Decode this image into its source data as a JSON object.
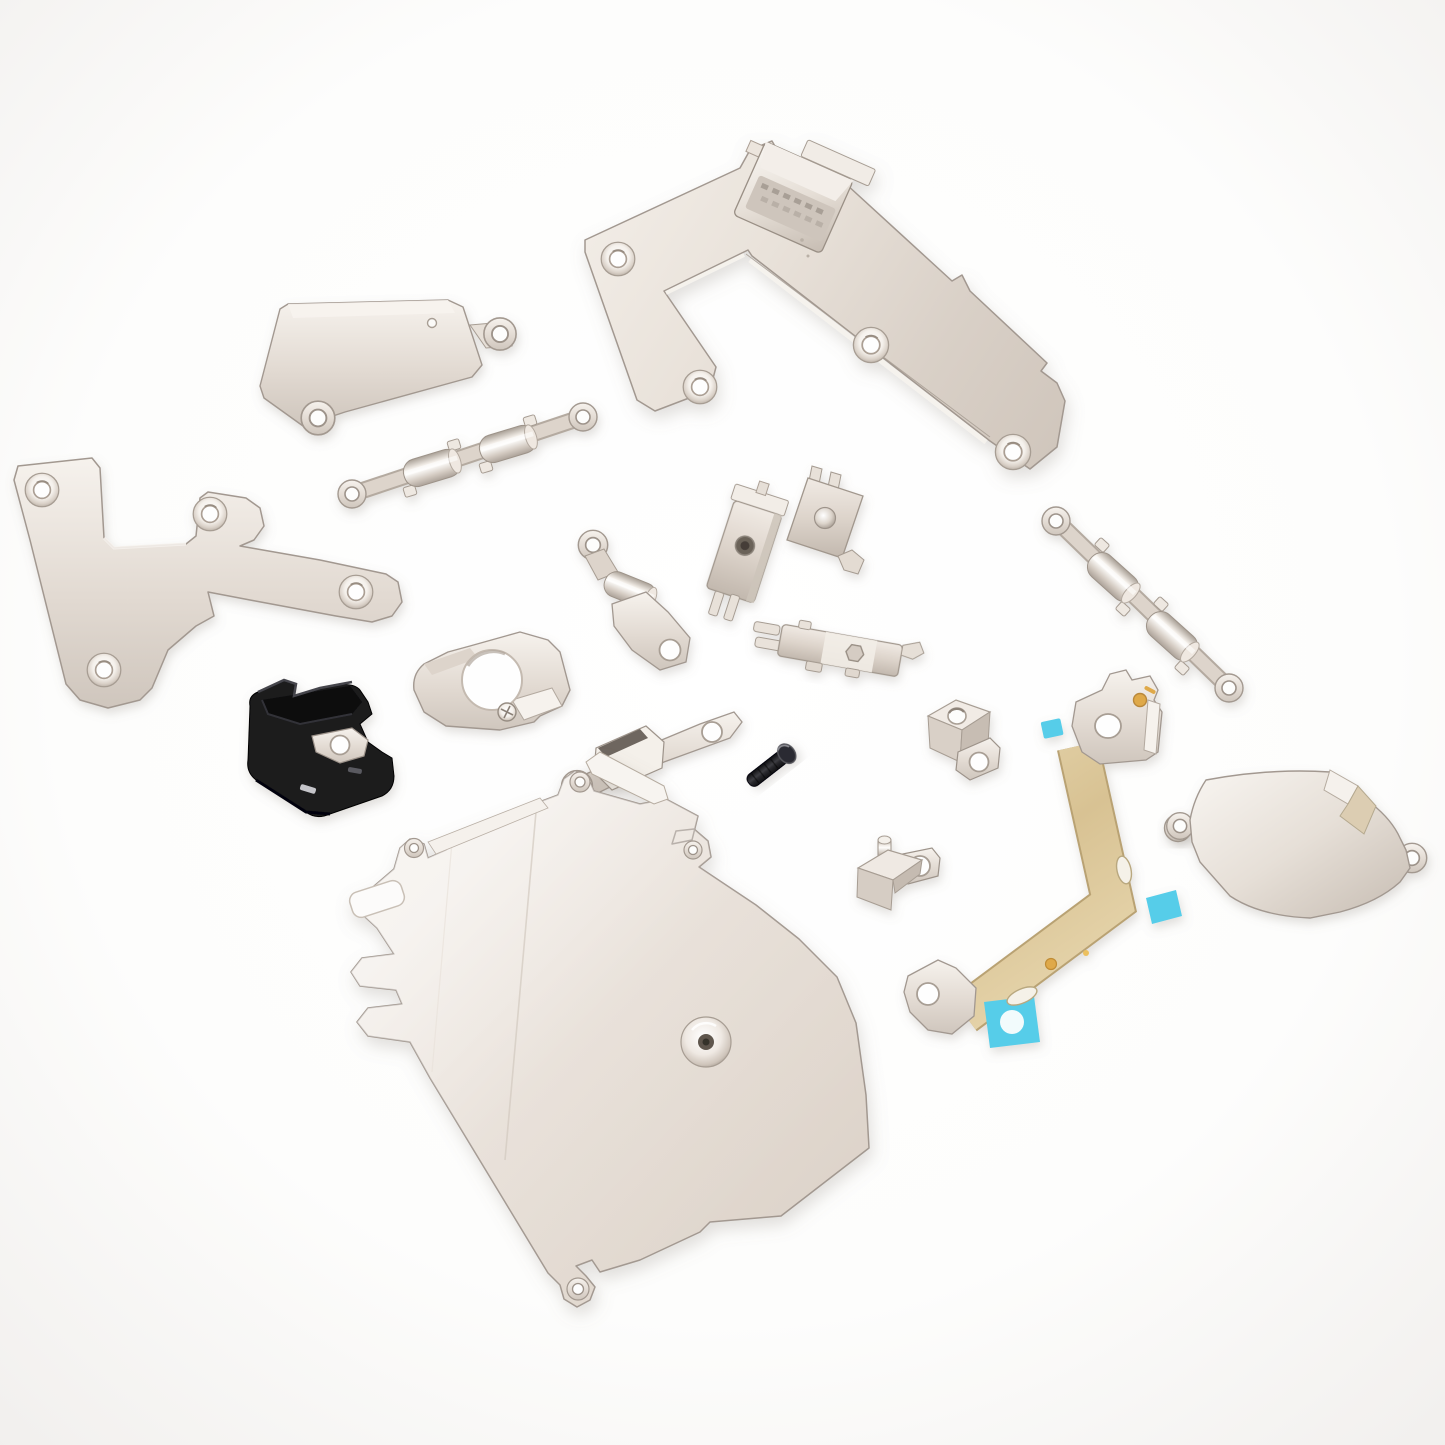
{
  "scene": {
    "kind": "product-photo",
    "subject": "Set of internal replacement metal brackets, shield plates, flex cable and fasteners for a smartphone, loosely arranged on a white seamless background",
    "background_color": "#fdfdfc",
    "part_count": 19,
    "palette": {
      "metal_light": "#f4efe9",
      "metal_mid": "#ddd4cb",
      "metal_dark": "#b9afa5",
      "metal_edge": "#a79d93",
      "plastic_black": "#1a1a1d",
      "plastic_black_highlight": "#333338",
      "flex_gold": "#ddc99e",
      "flex_gold_edge": "#b9a273",
      "adhesive_cyan": "#57cde9",
      "adhesive_cyan_light": "#f2fbfc",
      "contact_gold": "#dfa94a",
      "screw_black": "#1c1c1f",
      "hole_white": "#fefefe"
    },
    "parts": [
      {
        "id": "main-connector-bracket",
        "label": "large L-shaped logic board / display connector bracket with board-to-board connector block",
        "screw_holes": 4
      },
      {
        "id": "rectangular-retainer-plate",
        "label": "rectangular retaining bracket with two eyelet ears",
        "screw_holes": 2
      },
      {
        "id": "clamp-bracket-horizontal",
        "label": "double-barrel clamp bracket with end eyelets",
        "screw_holes": 2
      },
      {
        "id": "l-shaped-cover-plate",
        "label": "flat L-shaped connector cover plate",
        "screw_holes": 4
      },
      {
        "id": "black-plastic-holder",
        "label": "black plastic holder with metal tab",
        "screw_holes": 1
      },
      {
        "id": "camera-retainer-bracket",
        "label": "camera retaining bracket with round opening and screw",
        "screw_holes": 1
      },
      {
        "id": "eyelet-clamp-bracket",
        "label": "small clamp bracket with eyelet and foot plate",
        "screw_holes": 2
      },
      {
        "id": "contact-bracket-screw",
        "label": "vertical contact bracket with screw and bottom prongs",
        "screw_holes": 1
      },
      {
        "id": "dome-contact-bracket",
        "label": "forked contact bracket with dome button",
        "screw_holes": 0
      },
      {
        "id": "hex-contact-bracket",
        "label": "contact bracket with hex opening, prongs and hook",
        "screw_holes": 1
      },
      {
        "id": "clamp-bracket-diagonal",
        "label": "double-barrel clamp bracket with end eyelets, diagonal",
        "screw_holes": 2
      },
      {
        "id": "grounding-block",
        "label": "metal grounding block with top hole and eyelet tab",
        "screw_holes": 2
      },
      {
        "id": "box-retainer-bracket",
        "label": "retaining bracket with raised box section and eyelets",
        "screw_holes": 2
      },
      {
        "id": "black-screw",
        "label": "small black machine screw",
        "screw_holes": 0
      },
      {
        "id": "stud-block",
        "label": "metal block with stud post and eyelet tab",
        "screw_holes": 1
      },
      {
        "id": "antenna-flex-cable",
        "label": "gold antenna flex cable with cyan adhesive pads and gold contacts",
        "screw_holes": 2
      },
      {
        "id": "washer",
        "label": "small metal washer",
        "screw_holes": 1
      },
      {
        "id": "rounded-shield-plate",
        "label": "rounded square shield plate with folded tab and two eyelets",
        "screw_holes": 2
      },
      {
        "id": "main-shield-plate",
        "label": "large main board shield plate with raised screw boss and eyelet tabs",
        "screw_holes": 1
      }
    ]
  }
}
